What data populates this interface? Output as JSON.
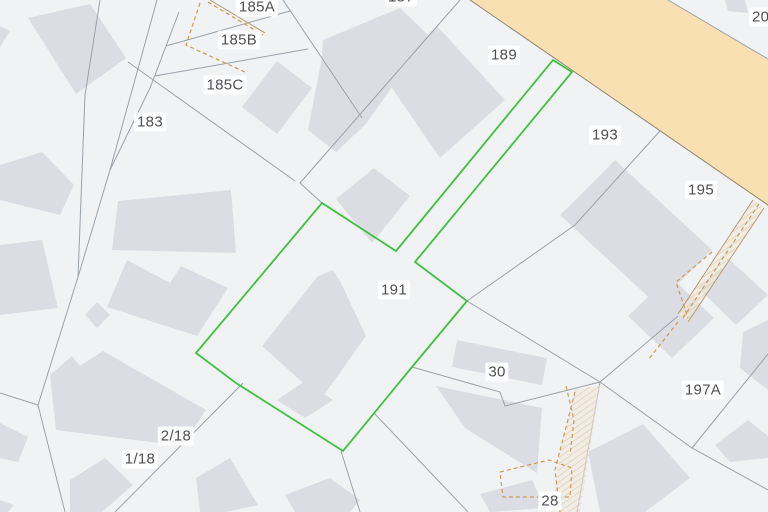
{
  "map": {
    "width": 768,
    "height": 512,
    "background_color": "#f1f2f4",
    "building_color": "#dcdde2",
    "boundary_color": "#9aa2a9",
    "road": {
      "name": "road-area",
      "fill": "#f8e0b2",
      "points": "470,0 668,0 768,59 768,206"
    },
    "road_edges": [
      {
        "points": "470,0 768,205",
        "color": "#8f8574"
      },
      {
        "points": "668,0 768,59",
        "color": "#9aa2a9"
      }
    ],
    "selected_parcel": {
      "label": "191",
      "color": "#3fc13f",
      "points": "196,353 322,203 396,251 553,60 572,72 415,262 467,301 412,367 343,451 236,383"
    },
    "boundary_lines": [
      "100,0 85,95 78,277",
      "157,0 110,170 78,277 38,405",
      "179,12 150,88 110,170",
      "166,46 290,11",
      "155,76 308,49",
      "128,62 295,181",
      "283,0 362,118",
      "460,0 300,183 322,203",
      "38,405 0,393",
      "38,405 65,512",
      "243,383 115,512",
      "374,413 468,512",
      "341,451 360,512",
      "412,367 500,392 505,406 600,382",
      "467,301 600,382",
      "600,382 577,512",
      "600,382 692,448 768,490",
      "692,448 768,354",
      "660,131 575,225 467,301",
      "678,316 600,382"
    ],
    "buildings": [
      "28,18 90,4 126,58 76,94",
      "0,26 10,31 0,47",
      "0,165 42,152 74,185 60,215 0,200",
      "0,245 42,240 58,308 0,315",
      "112,250 118,201 231,190 236,253",
      "107,307 127,260 170,283 181,266 228,288 197,336",
      "85,315 97,302 110,315 97,328",
      "242,107 277,61 312,88 277,134",
      "322,57 323,40 400,8 428,35 366,124 336,152 308,130",
      "336,199 374,168 410,196 372,243",
      "437,26 385,78 440,158 505,100",
      "725,0 745,0 748,13 728,11",
      "560,215 615,160 712,250 657,305",
      "628,316 670,276 714,318 672,358",
      "698,288 730,260 768,295 736,325",
      "743,332 768,320 768,390 740,368",
      "715,445 748,420 768,436 768,458 730,462",
      "262,346 318,276 333,270 341,283 366,336 321,399",
      "277,400 305,381 333,400 305,418",
      "457,340 547,358 542,385 452,367",
      "436,386 542,408 537,473 465,428",
      "588,452 643,424 690,478 645,512 600,512",
      "480,494 532,480 545,508 490,512",
      "50,375 72,356 80,366 103,351 206,410 182,446 56,430",
      "70,480 105,458 133,485 102,512 70,512",
      "0,423 28,437 18,462 0,458",
      "196,478 230,458 258,505 226,512 200,512",
      "285,495 330,478 360,500 350,512 295,512",
      "0,500 14,505 8,512 0,512"
    ],
    "easement_color": "#c99a58",
    "easement_solid_color": "#ab8c60",
    "hatch_line_color": "#dcc9a4",
    "easement_dashed": [
      "208,2 263,35",
      "200,3 186,45 247,73",
      "759,204 683,318",
      "712,252 676,282 688,318",
      "678,322 648,360",
      "575,392 555,470 560,512",
      "566,386 574,420 570,455",
      "500,472 549,460 572,468 570,497 503,497 500,472"
    ],
    "easement_solid": [
      "210,0 265,33",
      "753,200 678,314",
      "764,208 688,322"
    ],
    "hatch_areas": [
      "753,200 764,208 688,322 678,314",
      "575,390 600,385 580,512 552,512 560,450"
    ],
    "labels": [
      {
        "text": "187",
        "x": 401,
        "y": -3
      },
      {
        "text": "185A",
        "x": 257,
        "y": 7
      },
      {
        "text": "185B",
        "x": 239,
        "y": 40
      },
      {
        "text": "185C",
        "x": 225,
        "y": 85
      },
      {
        "text": "183",
        "x": 150,
        "y": 122
      },
      {
        "text": "189",
        "x": 504,
        "y": 55
      },
      {
        "text": "204",
        "x": 765,
        "y": 17
      },
      {
        "text": "193",
        "x": 605,
        "y": 135
      },
      {
        "text": "195",
        "x": 701,
        "y": 190
      },
      {
        "text": "191",
        "x": 394,
        "y": 290
      },
      {
        "text": "197A",
        "x": 703,
        "y": 390
      },
      {
        "text": "30",
        "x": 497,
        "y": 372
      },
      {
        "text": "2/18",
        "x": 176,
        "y": 436
      },
      {
        "text": "1/18",
        "x": 140,
        "y": 459
      },
      {
        "text": "28",
        "x": 550,
        "y": 501
      }
    ]
  }
}
